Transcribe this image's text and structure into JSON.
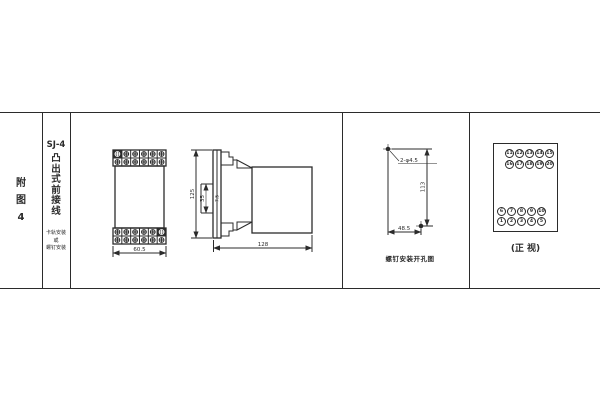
{
  "sheet": {
    "bg": "#ffffff",
    "ink": "#2b2b2b"
  },
  "title_block": {
    "figure_no_chars": [
      "附",
      "图",
      "4"
    ],
    "model": "SJ-4",
    "name_chars": [
      "凸",
      "出",
      "式",
      "前",
      "接",
      "线"
    ],
    "mount_lines": [
      "卡轨安装",
      "或",
      "螺钉安装"
    ]
  },
  "front_view": {
    "width_dim": "60.5"
  },
  "side_view": {
    "height_dim": "125",
    "rail_dim": "35",
    "depth_dim": "7.5",
    "length_dim": "128"
  },
  "drill_view": {
    "hole_label": "2-φ4.5",
    "vertical_dim": "113",
    "horizontal_dim": "48.5",
    "caption": "螺钉安装开孔图"
  },
  "terminal_view": {
    "rows": [
      [
        "11",
        "12",
        "13",
        "14",
        "15"
      ],
      [
        "16",
        "17",
        "18",
        "19",
        "20"
      ],
      [
        "6",
        "7",
        "8",
        "9",
        "10"
      ],
      [
        "1",
        "2",
        "3",
        "4",
        "5"
      ]
    ],
    "caption": "(正 视)"
  }
}
